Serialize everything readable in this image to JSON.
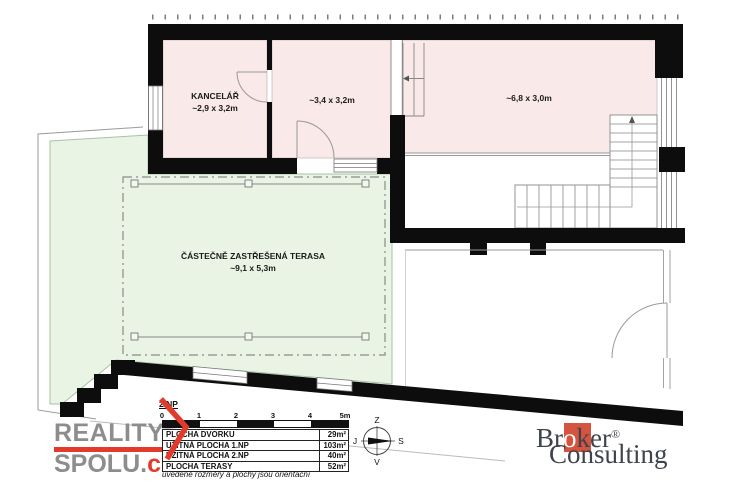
{
  "colors": {
    "wall": "#0d0d0d",
    "room_pink": "#f9e9e8",
    "terrace_green": "#e9f4e4",
    "accent_red": "#e23a2b",
    "broker_red": "#d4543f",
    "logo_grey": "#8d8d8d"
  },
  "plan": {
    "floor_label": "2.NP",
    "rooms": {
      "kancelar": {
        "name": "KANCELÁŘ",
        "dims": "~2,9 x 3,2m"
      },
      "middle": {
        "dims": "~3,4 x 3,2m"
      },
      "right": {
        "dims": "~6,8 x 3,0m"
      },
      "terrace": {
        "name": "ČÁSTEČNĚ ZASTŘEŠENÁ TERASA",
        "dims": "~9,1 x 5,3m"
      }
    }
  },
  "scalebar": {
    "ticks": [
      "0",
      "1",
      "2",
      "3",
      "4",
      "5m"
    ]
  },
  "legend": {
    "rows": [
      {
        "label": "PLOCHA DVORKU",
        "value": "29m²"
      },
      {
        "label": "UŽITNÁ PLOCHA 1.NP",
        "value": "103m²"
      },
      {
        "label": "UŽITNÁ PLOCHA 2.NP",
        "value": "40m²"
      },
      {
        "label": "PLOCHA TERASY",
        "value": "52m²"
      }
    ],
    "note": "uvedené rozměry a plochy jsou orientační"
  },
  "compass": {
    "top": "Z",
    "right": "S",
    "bottom": "V",
    "left": "J"
  },
  "logos": {
    "reality": {
      "line1": "REALITY",
      "line2": "SPOLU.",
      "tld": "cz"
    },
    "broker": {
      "b1": "Br",
      "o": "o",
      "b2": "ker",
      "reg": "®",
      "line2": "Consulting"
    }
  }
}
